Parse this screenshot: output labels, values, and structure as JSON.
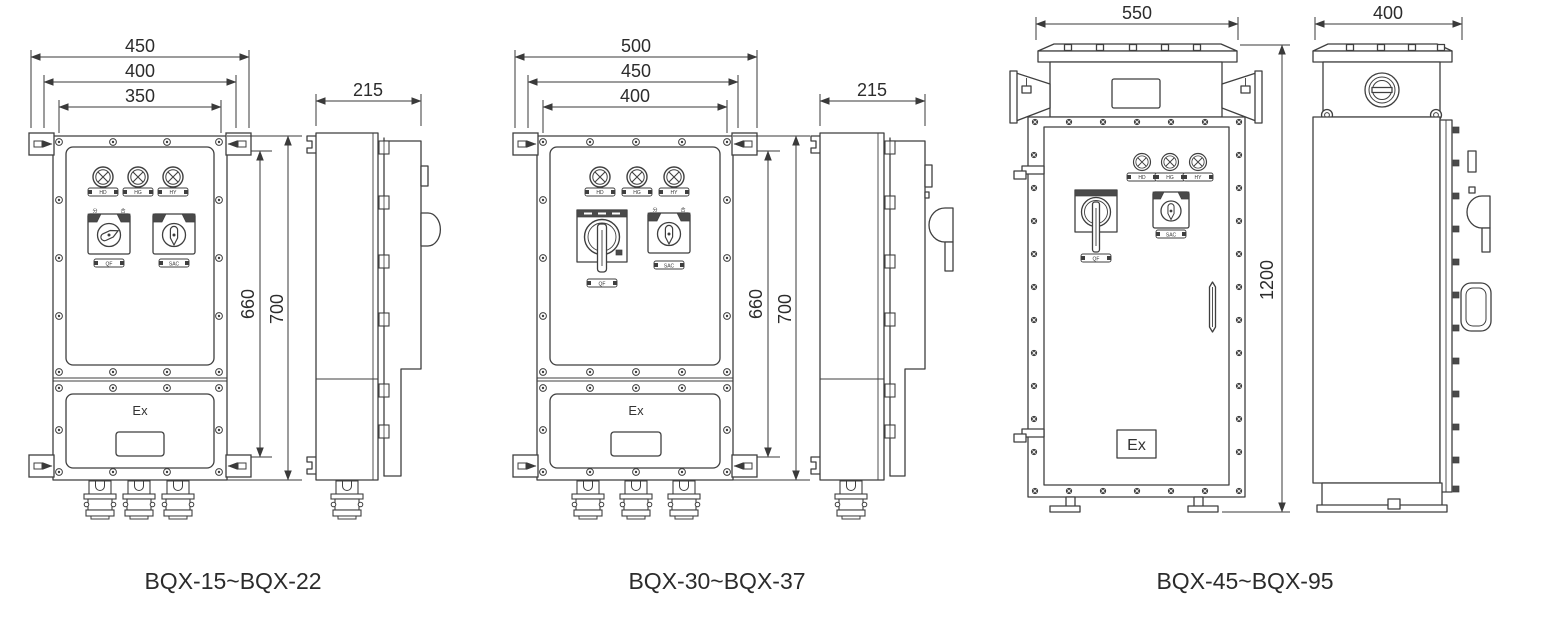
{
  "figure": {
    "background": "#ffffff",
    "line_color": "#3f3f3f",
    "groups": [
      {
        "caption": "BQX-15~BQX-22",
        "front": {
          "ex_label": "Ex",
          "dims": {
            "width_outer": "450",
            "width_mid": "400",
            "width_inner": "350",
            "height_inner": "660",
            "height_outer": "700"
          },
          "panel": {
            "lamp_labels": [
              "HD",
              "HG",
              "HY"
            ],
            "switch1_label": "QF",
            "switch2_label": "SAC",
            "switch1_corner_left": "分",
            "switch1_corner_right": "合"
          }
        },
        "side": {
          "dims": {
            "depth": "215"
          }
        }
      },
      {
        "caption": "BQX-30~BQX-37",
        "front": {
          "ex_label": "Ex",
          "dims": {
            "width_outer": "500",
            "width_mid": "450",
            "width_inner": "400",
            "height_inner": "660",
            "height_outer": "700"
          },
          "panel": {
            "lamp_labels": [
              "HD",
              "HG",
              "HY"
            ],
            "switch1_label": "QF",
            "switch2_label": "SAC",
            "switch2_corner_left": "分",
            "switch2_corner_right": "合"
          }
        },
        "side": {
          "dims": {
            "depth": "215"
          }
        }
      },
      {
        "caption": "BQX-45~BQX-95",
        "front": {
          "ex_label": "Ex",
          "dims": {
            "width_outer": "550",
            "height_outer": "1200"
          },
          "panel": {
            "lamp_labels": [
              "HD",
              "HG",
              "HY"
            ],
            "switch1_label": "QF",
            "switch2_label": "SAC"
          }
        },
        "side": {
          "dims": {
            "depth": "400"
          }
        }
      }
    ]
  }
}
